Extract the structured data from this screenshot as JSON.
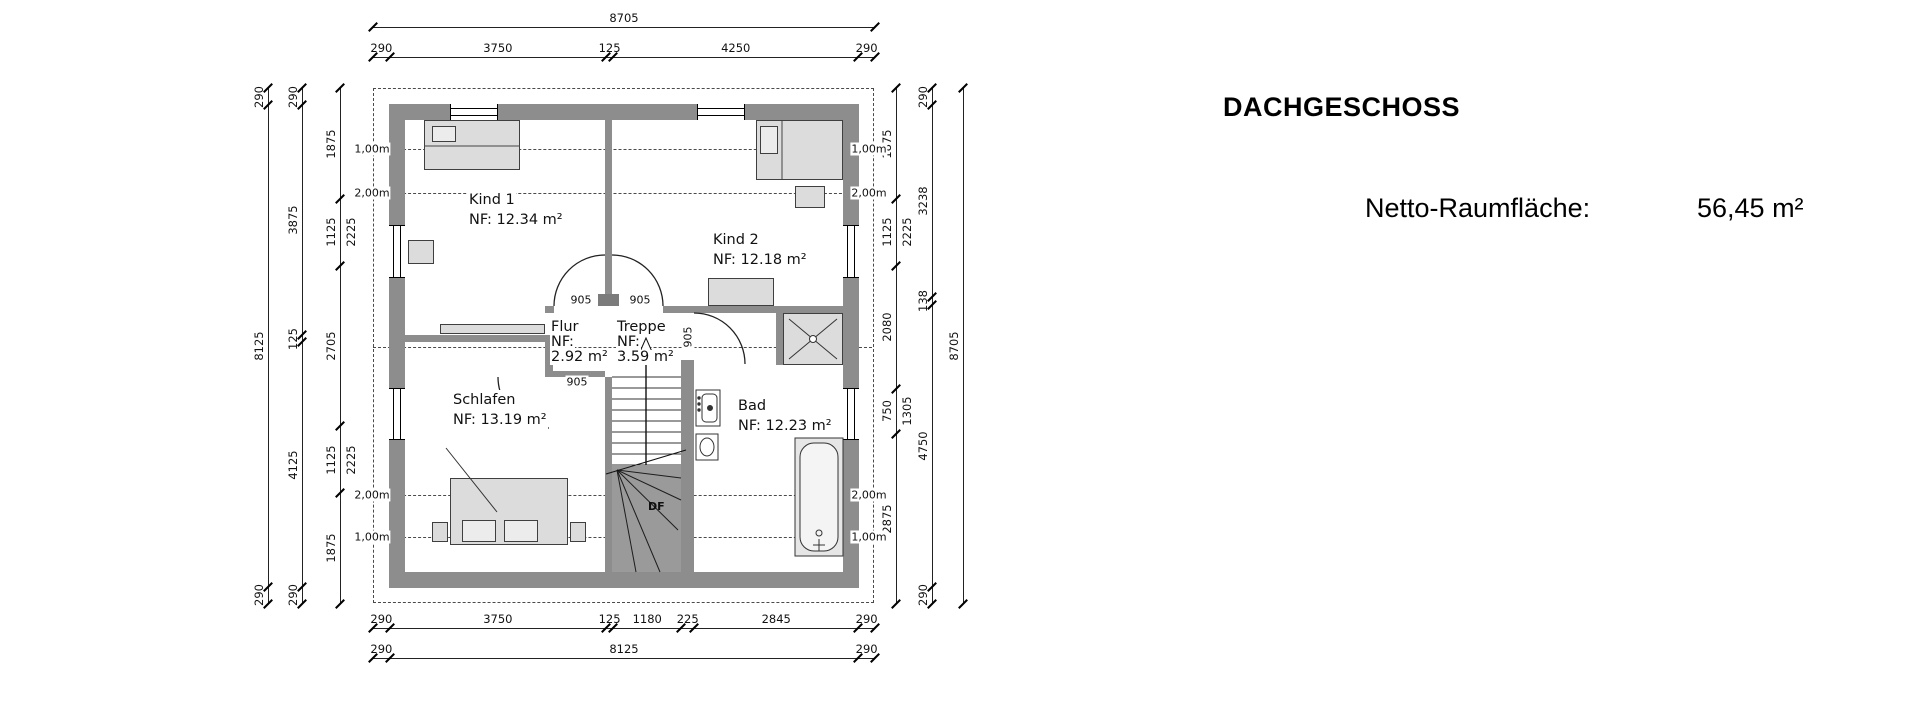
{
  "title": "DACHGESCHOSS",
  "netto": {
    "label": "Netto-Raumfläche:",
    "value": "56,45 m²"
  },
  "plan": {
    "rooms": [
      {
        "id": "kind1",
        "lines": [
          "Kind 1",
          "NF: 12.34 m²"
        ],
        "x": 468,
        "y": 190,
        "lh": 20
      },
      {
        "id": "kind2",
        "lines": [
          "Kind 2",
          "NF: 12.18 m²"
        ],
        "x": 712,
        "y": 230,
        "lh": 20
      },
      {
        "id": "flur",
        "lines": [
          "Flur",
          "NF:",
          "2.92 m²"
        ],
        "x": 550,
        "y": 320,
        "lh": 15
      },
      {
        "id": "treppe",
        "lines": [
          "Treppe",
          "NF:",
          "3.59 m²"
        ],
        "x": 616,
        "y": 320,
        "lh": 15
      },
      {
        "id": "schlafen",
        "lines": [
          "Schlafen",
          "NF: 13.19 m²"
        ],
        "x": 452,
        "y": 390,
        "lh": 20
      },
      {
        "id": "bad",
        "lines": [
          "Bad",
          "NF: 12.23 m²"
        ],
        "x": 737,
        "y": 396,
        "lh": 20
      }
    ],
    "door_labels": [
      {
        "text": "905",
        "x": 581,
        "y": 300,
        "rot": 0
      },
      {
        "text": "905",
        "x": 640,
        "y": 300,
        "rot": 0
      },
      {
        "text": "905",
        "x": 577,
        "y": 382,
        "rot": 0
      },
      {
        "text": "905",
        "x": 688,
        "y": 337,
        "rot": -90
      }
    ],
    "stair_label": {
      "text": "DF",
      "x": 648,
      "y": 500
    },
    "height_lines": [
      {
        "y": 149,
        "text": "1,00m"
      },
      {
        "y": 193,
        "text": "2,00m"
      },
      {
        "y": 347,
        "text": ""
      },
      {
        "y": 495,
        "text": "2,00m"
      },
      {
        "y": 537,
        "text": "1,00m"
      }
    ],
    "height_label_x": {
      "left": 372,
      "right": 869
    },
    "chains": [
      {
        "id": "top-total",
        "orient": "h",
        "x": 373,
        "y": 27,
        "len": 502,
        "segs": [
          {
            "label": "8705",
            "mm": 8705
          }
        ]
      },
      {
        "id": "top-parts",
        "orient": "h",
        "x": 373,
        "y": 57,
        "len": 502,
        "segs": [
          {
            "label": "290",
            "mm": 290
          },
          {
            "label": "3750",
            "mm": 3750
          },
          {
            "label": "125",
            "mm": 125
          },
          {
            "label": "4250",
            "mm": 4250
          },
          {
            "label": "290",
            "mm": 290
          }
        ]
      },
      {
        "id": "bottom-parts",
        "orient": "h",
        "x": 373,
        "y": 628,
        "len": 502,
        "segs": [
          {
            "label": "290",
            "mm": 290
          },
          {
            "label": "3750",
            "mm": 3750
          },
          {
            "label": "125",
            "mm": 125
          },
          {
            "label": "1180",
            "mm": 1180
          },
          {
            "label": "225",
            "mm": 225
          },
          {
            "label": "2845",
            "mm": 2845
          },
          {
            "label": "290",
            "mm": 290
          }
        ]
      },
      {
        "id": "bottom-total",
        "orient": "h",
        "x": 373,
        "y": 658,
        "len": 502,
        "segs": [
          {
            "label": "290",
            "mm": 290
          },
          {
            "label": "8125",
            "mm": 8125
          },
          {
            "label": "290",
            "mm": 290
          }
        ]
      },
      {
        "id": "left-total",
        "orient": "v",
        "x": 268,
        "y": 88,
        "len": 516,
        "segs": [
          {
            "label": "290",
            "mm": 290
          },
          {
            "label": "8125",
            "mm": 8125
          },
          {
            "label": "290",
            "mm": 290
          }
        ]
      },
      {
        "id": "left-parts",
        "orient": "v",
        "x": 302,
        "y": 88,
        "len": 516,
        "segs": [
          {
            "label": "290",
            "mm": 290
          },
          {
            "label": "3875",
            "mm": 3875
          },
          {
            "label": "125",
            "mm": 125
          },
          {
            "label": "4125",
            "mm": 4125
          },
          {
            "label": "290",
            "mm": 290
          }
        ]
      },
      {
        "id": "left-inner",
        "orient": "v",
        "x": 340,
        "y": 88,
        "len": 516,
        "segs": [
          {
            "label": "1875",
            "mm": 1875
          },
          {
            "label": "1125",
            "label2": "2225",
            "mm": 1125
          },
          {
            "label": "2705",
            "mm": 2705
          },
          {
            "label": "1125",
            "label2": "2225",
            "mm": 1125
          },
          {
            "label": "1875",
            "mm": 1875
          }
        ]
      },
      {
        "id": "right-inner",
        "orient": "v",
        "x": 896,
        "y": 88,
        "len": 516,
        "segs": [
          {
            "label": "1875",
            "mm": 1875
          },
          {
            "label": "1125",
            "label2": "2225",
            "mm": 1125
          },
          {
            "label": "2080",
            "mm": 2080
          },
          {
            "label": "750",
            "label2": "1305",
            "mm": 750
          },
          {
            "label": "2875",
            "mm": 2875
          }
        ]
      },
      {
        "id": "right-parts",
        "orient": "v",
        "x": 932,
        "y": 88,
        "len": 516,
        "segs": [
          {
            "label": "290",
            "mm": 290
          },
          {
            "label": "3238",
            "mm": 3238
          },
          {
            "label": "138",
            "mm": 138
          },
          {
            "label": "4750",
            "mm": 4750
          },
          {
            "label": "290",
            "mm": 290
          }
        ]
      },
      {
        "id": "right-total",
        "orient": "v",
        "x": 963,
        "y": 88,
        "len": 516,
        "segs": [
          {
            "label": "8705",
            "mm": 8705
          }
        ]
      }
    ]
  }
}
